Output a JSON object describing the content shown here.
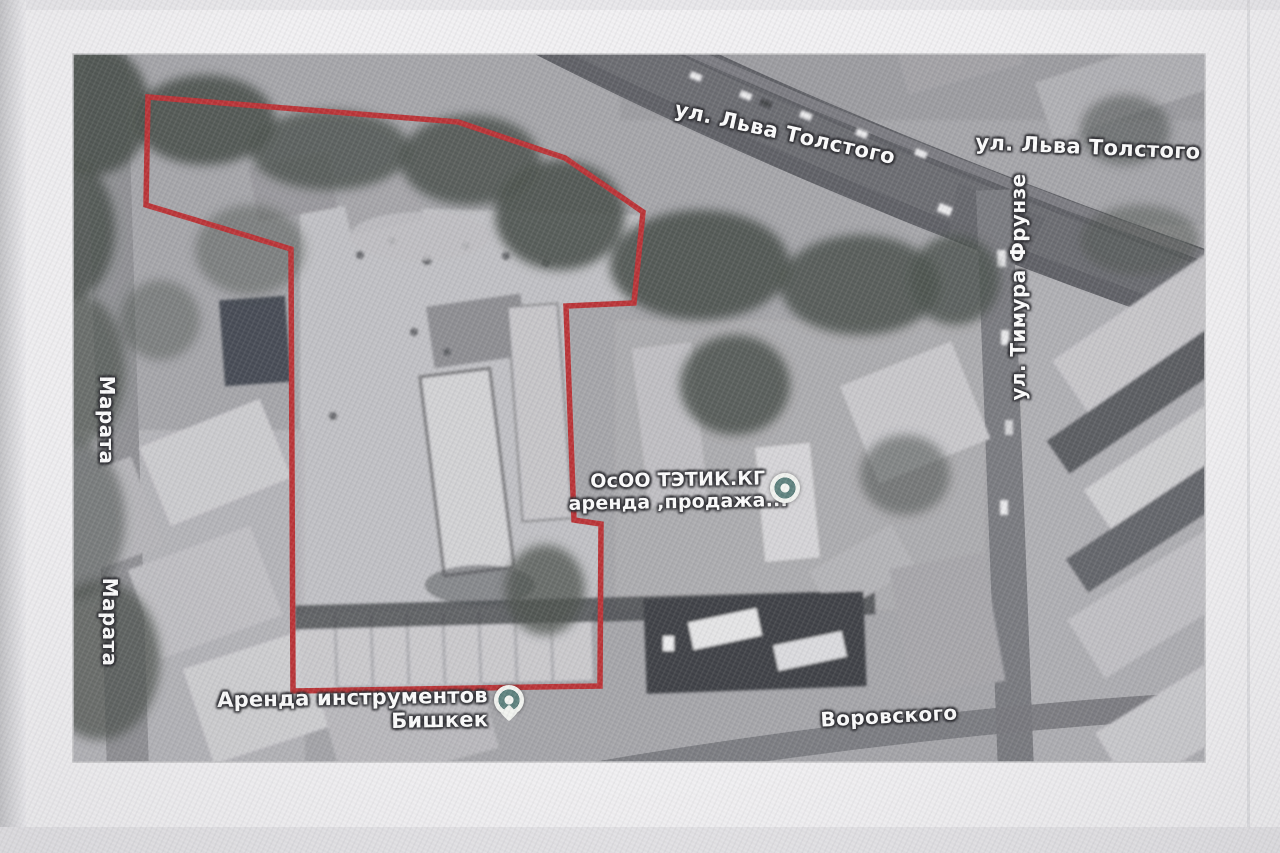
{
  "photo": {
    "background_color": "#f2f1f3",
    "map_background": "#a7a7ad"
  },
  "map": {
    "streets": [
      {
        "label": "ул. Льва Толстого"
      },
      {
        "label": "ул. Льва Толстого"
      },
      {
        "label": "ул. Тимура Фрунзе"
      },
      {
        "label": "Марата"
      },
      {
        "label": "Марата"
      },
      {
        "label": "Воровского"
      }
    ],
    "pois": [
      {
        "line1": "ОсОО ТЭТИК.КГ",
        "line2": "аренда ,продажа...",
        "marker": "dot"
      },
      {
        "line1": "Аренда инструментов",
        "line2": "Бишкек",
        "marker": "pin"
      }
    ],
    "outline": {
      "color": "#e8262b",
      "points": "148,97 458,122 565,158 643,212 634,303 566,306 574,520 601,524 600,686 293,691 291,249 146,205"
    },
    "marker_colors": {
      "ring": "#5e827e",
      "fill": "#f2f4f0"
    }
  }
}
